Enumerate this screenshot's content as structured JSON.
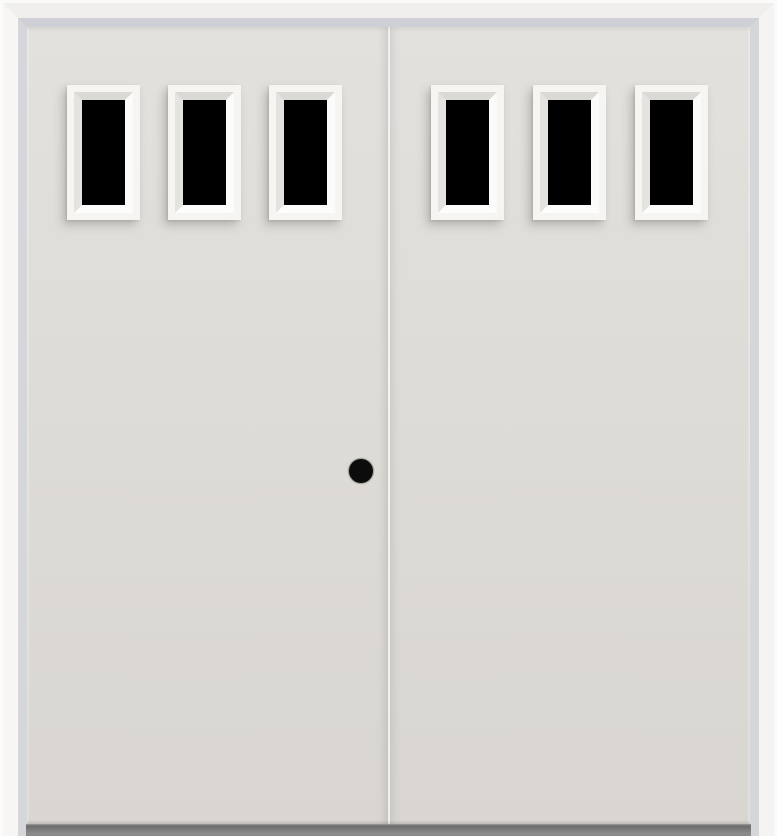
{
  "image": {
    "type": "product-photo",
    "subject": "prehung double entry door, smooth off-white slabs, three rectangular dark-glass lites across the top of each door, white frame, dark gray sill, round black knob bore on left door near center seam"
  },
  "door_unit": {
    "configuration": "double-door",
    "panels": [
      {
        "name": "left-door",
        "lite_count": 3,
        "knob_bore": true
      },
      {
        "name": "right-door",
        "lite_count": 3,
        "knob_bore": false
      }
    ],
    "total_lites": 6,
    "lite_style": "rectangular, single top row, recessed beveled white frames",
    "glass": "dark / opaque black",
    "frame": "white mitered jamb with gray reveal line",
    "sill": "dark gray threshold strip at bottom"
  },
  "colors": {
    "background": "#ffffff",
    "frame_white": "#f5f4f2",
    "frame_white_top": "#f0efed",
    "frame_white_left": "#f7f6f4",
    "frame_edge_highlight": "#fcfcfc",
    "frame_reveal_gray": "#d4d6da",
    "frame_reveal_gray_top": "#ced0d5",
    "door_slab": "#dedcd7",
    "door_slab_light": "#e3e1dd",
    "door_slab_dark": "#d9d6d1",
    "seam_light": "#f1f1f4",
    "lite_frame": "#f6f5f2",
    "lite_bevel_shadow": "#dbd9d5",
    "lite_bevel_mid": "#e5e3e0",
    "lite_bevel_light": "#fbfbfa",
    "lite_bevel_bright": "#fdfdfc",
    "glass_black": "#000000",
    "knob_black": "#0c0c0c",
    "sill_top": "#9e9e9e",
    "sill_dark": "#6c6c6c",
    "sill_mid": "#828282"
  }
}
